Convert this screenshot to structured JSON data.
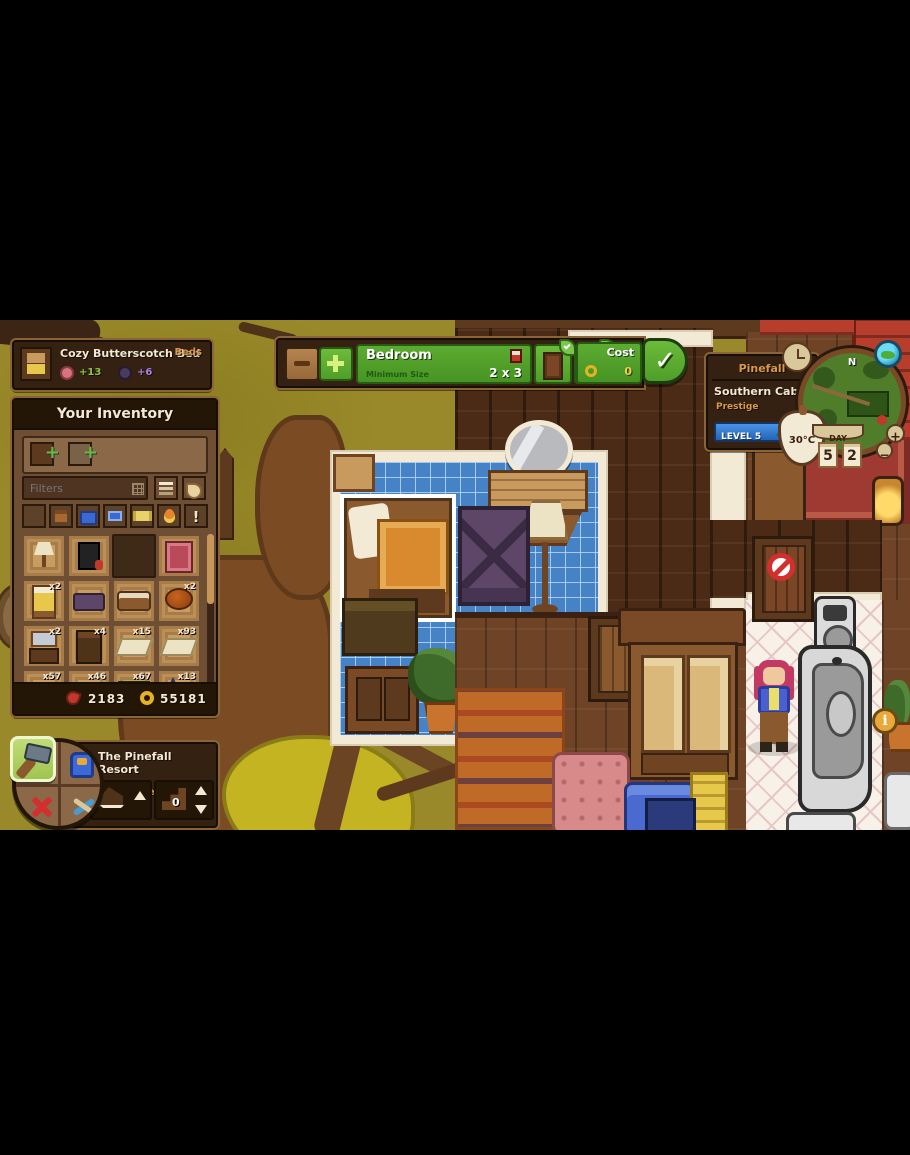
{
  "icons": {
    "check": "✓",
    "up": "▲",
    "down": "▼",
    "back": "◀",
    "plus": "+",
    "minus": "−",
    "info": "i",
    "excl": "!",
    "north": "N"
  },
  "tooltip": {
    "title": "Cozy Butterscotch Bed",
    "category": "Beds",
    "comfort_bonus": "+13",
    "decor_bonus": "+6"
  },
  "inventory": {
    "title": "Your Inventory",
    "filters_placeholder": "Filters",
    "items": [
      {
        "name": "lamp",
        "count": ""
      },
      {
        "name": "stove",
        "count": ""
      },
      {
        "name": "empty",
        "count": ""
      },
      {
        "name": "rug",
        "count": ""
      },
      {
        "name": "bed",
        "count": "x2"
      },
      {
        "name": "bench",
        "count": ""
      },
      {
        "name": "sofa",
        "count": ""
      },
      {
        "name": "round-table",
        "count": "x2"
      },
      {
        "name": "vanity",
        "count": "x2"
      },
      {
        "name": "cabinet",
        "count": "x4"
      },
      {
        "name": "floor-mat",
        "count": "x15"
      },
      {
        "name": "floor-mat-2",
        "count": "x93"
      },
      {
        "name": "stone-block",
        "count": "x57"
      },
      {
        "name": "sheet",
        "count": "x46"
      },
      {
        "name": "green-table",
        "count": "x67"
      },
      {
        "name": "witch-kit",
        "count": "x13"
      }
    ],
    "currency": {
      "scraps": "2183",
      "coins": "55181"
    }
  },
  "room_bar": {
    "room_name": "Bedroom",
    "min_size_label": "Minimum Size",
    "min_size_value": "2 x 3",
    "cost_label": "Cost",
    "cost_value": "0"
  },
  "location_panel": {
    "region": "Pinefall",
    "site": "Southern Cabin",
    "prestige_label": "Prestige",
    "level_label": "LEVEL 5",
    "temperature": "30°C",
    "day_label": "DAY",
    "day_digit_1": "5",
    "day_digit_2": "2"
  },
  "build_menu": {
    "title": "The Pinefall Resort",
    "location": "Southern Cabin",
    "floor_value": "0"
  },
  "colors": {
    "accent_green": "#57a82e",
    "panel_brown": "#342111",
    "ui_tan": "#c89658",
    "level_blue": "#2f7fd9",
    "tile_blue": "#4583c6"
  }
}
